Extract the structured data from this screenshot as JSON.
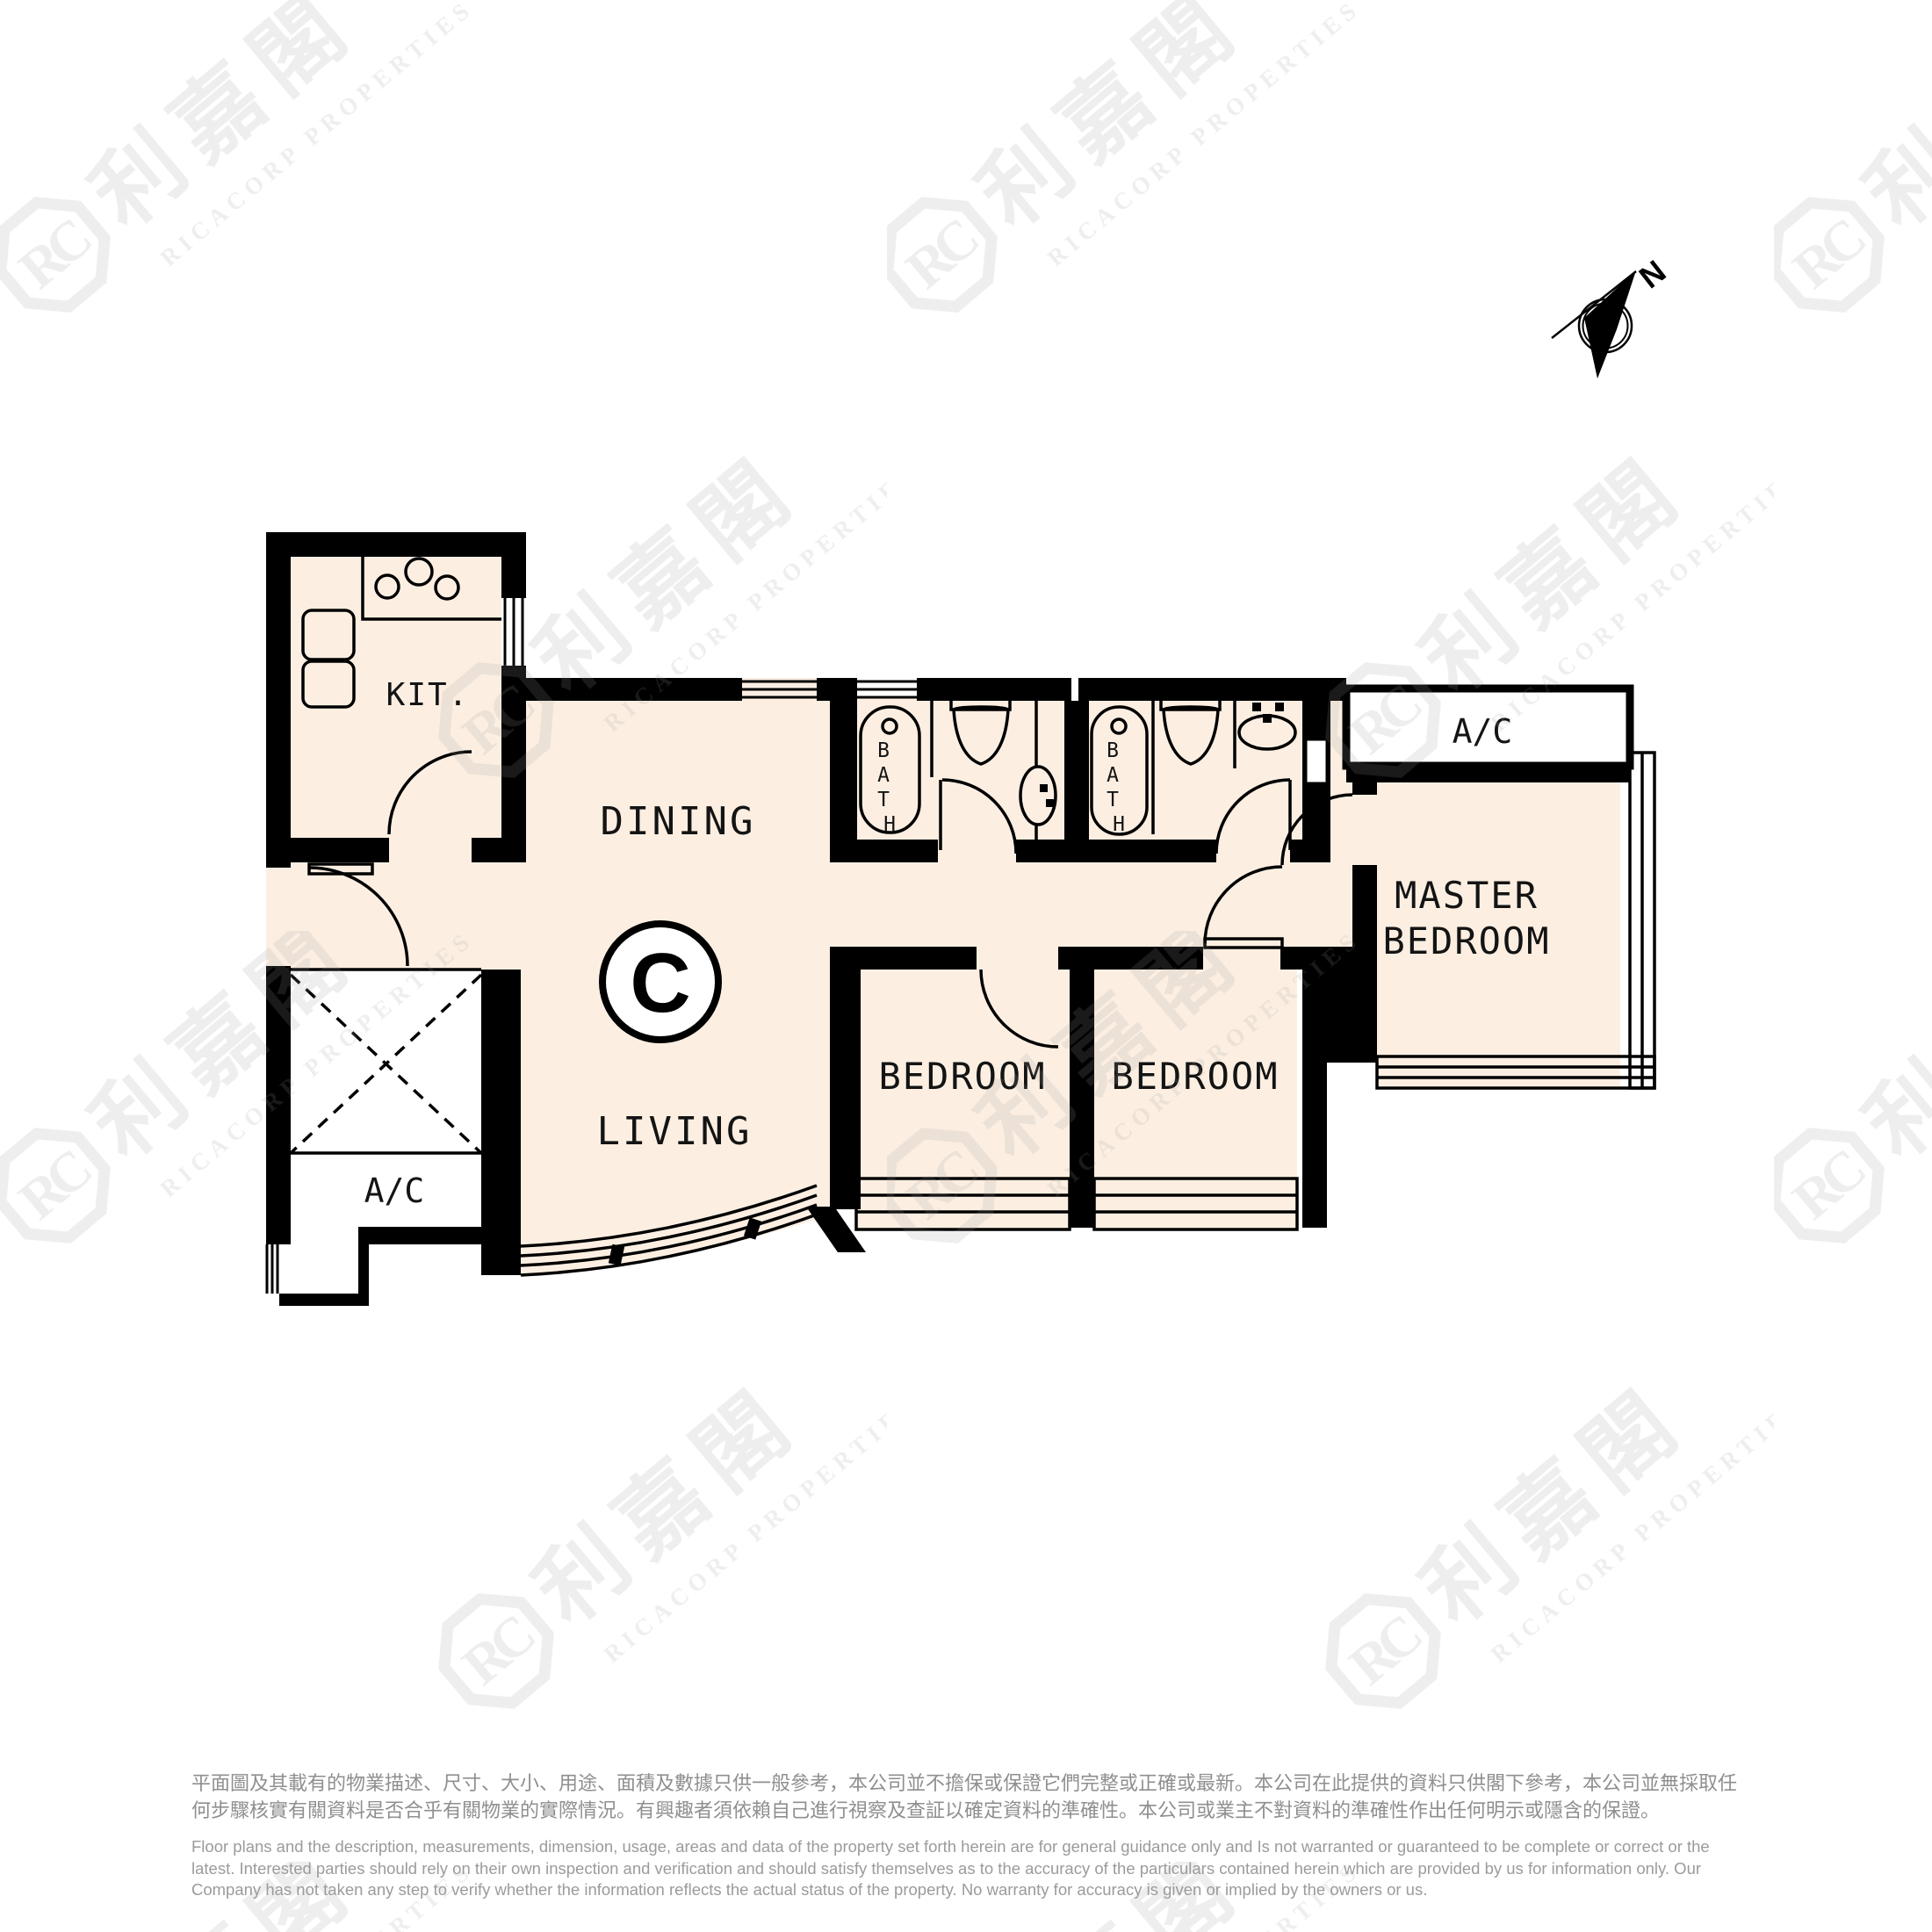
{
  "plan": {
    "unit_label": "C",
    "rooms": {
      "kitchen": "KIT.",
      "dining": "DINING",
      "living": "LIVING",
      "bedrooms": [
        "BEDROOM",
        "BEDROOM"
      ],
      "master": [
        "MASTER",
        "BEDROOM"
      ]
    },
    "fixtures": {
      "bath_letters": [
        "B",
        "A",
        "T",
        "H"
      ]
    },
    "ac_labels": [
      "A/C",
      "A/C"
    ],
    "compass_label": "N"
  },
  "watermark": {
    "cjk": "利嘉閣",
    "en": "RICACORP PROPERTIES",
    "logo_initials": "RC"
  },
  "disclaimer": {
    "zh": [
      "平面圖及其載有的物業描述、尺寸、大小、用途、面積及數據只供一般參考，本公司並不擔保或保證它們完整或正確或最新。本公司在此提供的資料只供閣下參考，本公司並無採取任",
      "何步驟核實有關資料是否合乎有關物業的實際情況。有興趣者須依賴自己進行視察及查証以確定資料的準確性。本公司或業主不對資料的準確性作出任何明示或隱含的保證。"
    ],
    "en": [
      "Floor plans and the description, measurements, dimension, usage, areas and data of the property set forth herein are for general guidance only and Is not warranted or guaranteed to be complete or correct or the",
      "latest. Interested parties should rely on their own inspection and verification and should satisfy themselves as to the accuracy of the particulars contained herein which are provided by us for information only.  Our",
      "Company has not taken any step to verify whether the information reflects the actual status of the property.  No warranty for accuracy is given or implied by the owners or us."
    ]
  },
  "colors": {
    "floor": "#fcefe2",
    "wall": "#000000",
    "watermark": "#999999",
    "label": "#141414",
    "disclaimer_zh": "#8f8f8f",
    "disclaimer_en": "#9b9b9b"
  }
}
